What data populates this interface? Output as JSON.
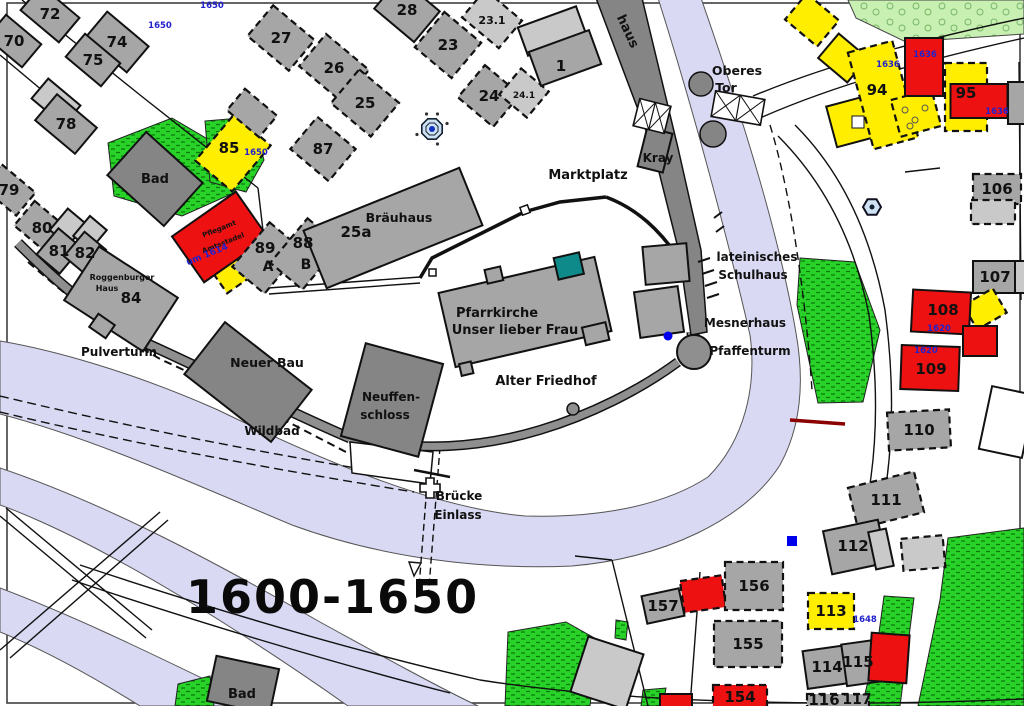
{
  "map": {
    "period_label": "1600-1650",
    "colors": {
      "gray": "#a6a6a6",
      "gray_dark": "#858585",
      "gray_light": "#c9c9c9",
      "yellow": "#ffee00",
      "red": "#ee1111",
      "white": "#ffffff",
      "teal": "#0e8a8a",
      "wall": "#8f8f8f",
      "water": "#d9d9f3",
      "green": "#28d228",
      "green_dark": "#0b7a0b",
      "green_light": "#c7f0b2",
      "year_blue": "#2222cc",
      "ink": "#111111",
      "dark_red": "#8b0000",
      "fountain_fill": "#cfe2f4",
      "dot_blue": "#1133bb"
    },
    "buildings": [
      {
        "id": "b70",
        "label": "70",
        "x": 14,
        "y": 41,
        "w": 46,
        "h": 30,
        "rot": 40,
        "f": "gray"
      },
      {
        "id": "b72",
        "label": "72",
        "x": 50,
        "y": 14,
        "w": 50,
        "h": 32,
        "rot": 40,
        "f": "gray"
      },
      {
        "id": "b74",
        "label": "74",
        "x": 117,
        "y": 42,
        "w": 54,
        "h": 34,
        "rot": 40,
        "f": "gray"
      },
      {
        "id": "b75",
        "label": "75",
        "x": 93,
        "y": 60,
        "w": 46,
        "h": 30,
        "rot": 40,
        "f": "gray"
      },
      {
        "id": "b78u",
        "x": 56,
        "y": 102,
        "w": 42,
        "h": 26,
        "rot": 40,
        "f": "gray_light"
      },
      {
        "id": "b78",
        "label": "78",
        "x": 66,
        "y": 124,
        "w": 52,
        "h": 34,
        "rot": 40,
        "f": "gray"
      },
      {
        "id": "b79",
        "label": "79",
        "x": 9,
        "y": 190,
        "w": 44,
        "h": 30,
        "rot": 40,
        "f": "gray",
        "dash": true
      },
      {
        "id": "b80",
        "label": "80",
        "x": 42,
        "y": 228,
        "w": 46,
        "h": 32,
        "rot": 40,
        "f": "gray",
        "dash": true
      },
      {
        "id": "b81u",
        "x": 68,
        "y": 227,
        "w": 24,
        "h": 28,
        "rot": 40,
        "f": "gray_light"
      },
      {
        "id": "b82u",
        "x": 90,
        "y": 233,
        "w": 22,
        "h": 26,
        "rot": 40,
        "f": "gray_light"
      },
      {
        "id": "b81",
        "label": "81",
        "x": 59,
        "y": 251,
        "w": 30,
        "h": 34,
        "rot": 40,
        "f": "gray"
      },
      {
        "id": "b82",
        "label": "82",
        "x": 85,
        "y": 253,
        "w": 28,
        "h": 32,
        "rot": 40,
        "f": "gray"
      },
      {
        "id": "b84",
        "label": "84",
        "lx": 131,
        "ly": 298,
        "x": 121,
        "y": 299,
        "w": 94,
        "h": 64,
        "rot": 33,
        "f": "gray"
      },
      {
        "id": "bad-top",
        "x": 155,
        "y": 179,
        "w": 76,
        "h": 58,
        "rot": 42,
        "f": "gray_dark"
      },
      {
        "id": "b85",
        "label": "85",
        "lx": 229,
        "ly": 148,
        "x": 233,
        "y": 153,
        "w": 48,
        "h": 60,
        "rot": 40,
        "f": "yellow",
        "dash": true
      },
      {
        "id": "bu1",
        "x": 252,
        "y": 113,
        "w": 42,
        "h": 28,
        "rot": 40,
        "f": "gray",
        "dash": true
      },
      {
        "id": "b87",
        "label": "87",
        "x": 323,
        "y": 149,
        "w": 50,
        "h": 42,
        "rot": 40,
        "f": "gray",
        "dash": true
      },
      {
        "id": "b27",
        "label": "27",
        "x": 281,
        "y": 38,
        "w": 54,
        "h": 40,
        "rot": 40,
        "f": "gray",
        "dash": true
      },
      {
        "id": "b26",
        "label": "26",
        "x": 334,
        "y": 68,
        "w": 56,
        "h": 42,
        "rot": 40,
        "f": "gray",
        "dash": true
      },
      {
        "id": "b25",
        "label": "25",
        "x": 365,
        "y": 103,
        "w": 52,
        "h": 44,
        "rot": 40,
        "f": "gray",
        "dash": true
      },
      {
        "id": "b28",
        "label": "28",
        "x": 407,
        "y": 10,
        "w": 52,
        "h": 40,
        "rot": 40,
        "f": "gray"
      },
      {
        "id": "b23",
        "label": "23",
        "x": 448,
        "y": 45,
        "w": 48,
        "h": 46,
        "rot": 40,
        "f": "gray",
        "dash": true
      },
      {
        "id": "b231",
        "label": "23.1",
        "x": 492,
        "y": 19,
        "w": 48,
        "h": 36,
        "rot": 40,
        "f": "gray_light",
        "dash": true,
        "ls": 11
      },
      {
        "id": "b24",
        "label": "24",
        "x": 489,
        "y": 96,
        "w": 46,
        "h": 42,
        "rot": 40,
        "f": "gray",
        "dash": true
      },
      {
        "id": "b241",
        "label": "24.1",
        "x": 524,
        "y": 93,
        "w": 36,
        "h": 34,
        "rot": 40,
        "f": "gray_light",
        "dash": true,
        "ls": 9
      },
      {
        "id": "b1u",
        "x": 552,
        "y": 31,
        "w": 62,
        "h": 30,
        "rot": -20,
        "f": "gray_light"
      },
      {
        "id": "b1",
        "label": "1",
        "lx": 561,
        "ly": 66,
        "x": 565,
        "y": 58,
        "w": 64,
        "h": 36,
        "rot": -20,
        "f": "gray"
      },
      {
        "id": "pflegstadel-y",
        "x": 237,
        "y": 262,
        "w": 52,
        "h": 40,
        "rot": -35,
        "f": "yellow",
        "dash": true
      },
      {
        "id": "pflegstadel",
        "x": 220,
        "y": 237,
        "w": 78,
        "h": 56,
        "rot": -35,
        "f": "red"
      },
      {
        "id": "b89",
        "label": "89",
        "lx": 265,
        "ly": 248,
        "x": 267,
        "y": 258,
        "w": 42,
        "h": 58,
        "rot": 40,
        "f": "gray",
        "dash": true
      },
      {
        "id": "b88",
        "label": "88",
        "lx": 303,
        "ly": 243,
        "x": 305,
        "y": 254,
        "w": 42,
        "h": 58,
        "rot": 40,
        "f": "gray",
        "dash": true
      },
      {
        "id": "b25a",
        "label": "25a",
        "lx": 356,
        "ly": 232,
        "x": 393,
        "y": 228,
        "w": 168,
        "h": 62,
        "rot": -22,
        "f": "gray"
      },
      {
        "id": "neuer-bau",
        "x": 248,
        "y": 382,
        "w": 110,
        "h": 66,
        "rot": 38,
        "f": "gray_dark"
      },
      {
        "id": "neuffenschloss",
        "x": 392,
        "y": 400,
        "w": 80,
        "h": 96,
        "rot": 15,
        "f": "gray_dark"
      },
      {
        "id": "mesner1",
        "x": 666,
        "y": 264,
        "w": 44,
        "h": 38,
        "rot": -5,
        "f": "gray"
      },
      {
        "id": "mesner2",
        "x": 659,
        "y": 312,
        "w": 44,
        "h": 46,
        "rot": -8,
        "f": "gray"
      },
      {
        "id": "kray-tower",
        "x": 655,
        "y": 150,
        "w": 26,
        "h": 40,
        "rot": 14,
        "f": "gray_dark"
      },
      {
        "id": "pulverturm-t",
        "x": 102,
        "y": 326,
        "w": 20,
        "h": 16,
        "rot": 35,
        "f": "gray"
      },
      {
        "id": "y1",
        "x": 812,
        "y": 20,
        "w": 42,
        "h": 34,
        "rot": 40,
        "f": "yellow",
        "dash": true
      },
      {
        "id": "y2",
        "x": 843,
        "y": 58,
        "w": 38,
        "h": 32,
        "rot": 40,
        "f": "yellow"
      },
      {
        "id": "y3",
        "x": 850,
        "y": 122,
        "w": 38,
        "h": 42,
        "rot": -15,
        "f": "yellow"
      },
      {
        "id": "b94",
        "label": "94",
        "lx": 877,
        "ly": 90,
        "x": 883,
        "y": 95,
        "w": 46,
        "h": 100,
        "rot": -15,
        "f": "yellow",
        "dash": true
      },
      {
        "id": "y4",
        "x": 916,
        "y": 113,
        "w": 42,
        "h": 38,
        "rot": -15,
        "f": "yellow",
        "dash": true
      },
      {
        "id": "red-top",
        "x": 924,
        "y": 67,
        "w": 38,
        "h": 58,
        "rot": 0,
        "f": "red"
      },
      {
        "id": "b95y",
        "x": 966,
        "y": 97,
        "w": 42,
        "h": 68,
        "rot": 0,
        "f": "yellow",
        "dash": true
      },
      {
        "id": "b95r",
        "label": "95",
        "lx": 966,
        "ly": 93,
        "x": 979,
        "y": 101,
        "w": 57,
        "h": 34,
        "rot": 0,
        "f": "red"
      },
      {
        "id": "edge-g1",
        "x": 1017,
        "y": 103,
        "w": 18,
        "h": 42,
        "rot": 0,
        "f": "gray"
      },
      {
        "id": "b106",
        "label": "106",
        "x": 997,
        "y": 189,
        "w": 48,
        "h": 30,
        "rot": 0,
        "f": "gray",
        "dash": true
      },
      {
        "id": "b106b",
        "x": 993,
        "y": 212,
        "w": 44,
        "h": 24,
        "rot": 0,
        "f": "gray_light",
        "dash": true
      },
      {
        "id": "b107",
        "label": "107",
        "lx": 995,
        "ly": 277,
        "x": 999,
        "y": 277,
        "w": 52,
        "h": 32,
        "rot": 0,
        "f": "gray"
      },
      {
        "id": "b107b",
        "x": 1021,
        "y": 277,
        "w": 12,
        "h": 32,
        "rot": 0,
        "f": "gray_light"
      },
      {
        "id": "y108",
        "x": 985,
        "y": 309,
        "w": 34,
        "h": 28,
        "rot": -30,
        "f": "yellow",
        "dash": true
      },
      {
        "id": "b108",
        "label": "108",
        "lx": 943,
        "ly": 310,
        "x": 941,
        "y": 312,
        "w": 58,
        "h": 42,
        "rot": 3,
        "f": "red"
      },
      {
        "id": "r108b",
        "x": 980,
        "y": 341,
        "w": 34,
        "h": 30,
        "rot": 0,
        "f": "red"
      },
      {
        "id": "b109",
        "label": "109",
        "lx": 931,
        "ly": 369,
        "x": 930,
        "y": 368,
        "w": 58,
        "h": 44,
        "rot": 2,
        "f": "red"
      },
      {
        "id": "b110",
        "label": "110",
        "x": 919,
        "y": 430,
        "w": 62,
        "h": 38,
        "rot": -3,
        "f": "gray",
        "dash": true
      },
      {
        "id": "white-right",
        "x": 1007,
        "y": 422,
        "w": 44,
        "h": 64,
        "rot": 12,
        "f": "white"
      },
      {
        "id": "b111",
        "label": "111",
        "x": 886,
        "y": 500,
        "w": 68,
        "h": 42,
        "rot": -14,
        "f": "gray",
        "dash": true
      },
      {
        "id": "b112",
        "label": "112",
        "lx": 853,
        "ly": 546,
        "x": 855,
        "y": 547,
        "w": 56,
        "h": 44,
        "rot": -12,
        "f": "gray"
      },
      {
        "id": "b112b",
        "x": 881,
        "y": 549,
        "w": 18,
        "h": 38,
        "rot": -12,
        "f": "gray_light"
      },
      {
        "id": "bu2",
        "x": 923,
        "y": 553,
        "w": 42,
        "h": 32,
        "rot": -5,
        "f": "gray_light",
        "dash": true
      },
      {
        "id": "gray-par",
        "x": 607,
        "y": 673,
        "w": 58,
        "h": 58,
        "rot": 18,
        "f": "gray_light"
      },
      {
        "id": "b157",
        "label": "157",
        "x": 663,
        "y": 606,
        "w": 38,
        "h": 28,
        "rot": -12,
        "f": "gray"
      },
      {
        "id": "r157",
        "x": 703,
        "y": 594,
        "w": 42,
        "h": 32,
        "rot": -8,
        "f": "red",
        "dash": true
      },
      {
        "id": "b156",
        "label": "156",
        "x": 754,
        "y": 586,
        "w": 58,
        "h": 48,
        "rot": 0,
        "f": "gray",
        "dash": true
      },
      {
        "id": "b155",
        "label": "155",
        "x": 748,
        "y": 644,
        "w": 68,
        "h": 46,
        "rot": 0,
        "f": "gray",
        "dash": true
      },
      {
        "id": "b113",
        "label": "113",
        "x": 831,
        "y": 611,
        "w": 46,
        "h": 36,
        "rot": 0,
        "f": "yellow",
        "dash": true
      },
      {
        "id": "b114",
        "label": "114",
        "x": 827,
        "y": 667,
        "w": 44,
        "h": 38,
        "rot": -8,
        "f": "gray"
      },
      {
        "id": "b115",
        "label": "115",
        "lx": 858,
        "ly": 662,
        "x": 861,
        "y": 663,
        "w": 34,
        "h": 42,
        "rot": -8,
        "f": "gray"
      },
      {
        "id": "r115",
        "x": 889,
        "y": 658,
        "w": 38,
        "h": 48,
        "rot": 4,
        "f": "red"
      },
      {
        "id": "b154",
        "label": "154",
        "x": 740,
        "y": 697,
        "w": 54,
        "h": 24,
        "rot": 0,
        "f": "red",
        "dash": true
      },
      {
        "id": "r154b",
        "x": 676,
        "y": 701,
        "w": 32,
        "h": 14,
        "rot": 0,
        "f": "red"
      },
      {
        "id": "b116",
        "label": "116",
        "lx": 824,
        "ly": 700,
        "x": 838,
        "y": 702,
        "w": 62,
        "h": 16,
        "rot": 0,
        "f": "gray",
        "dash": true
      },
      {
        "id": "bad-bottom",
        "x": 243,
        "y": 685,
        "w": 64,
        "h": 46,
        "rot": 12,
        "f": "gray_dark"
      }
    ],
    "places": [
      {
        "t": "Marktplatz",
        "x": 588,
        "y": 179,
        "s": 13
      },
      {
        "t": "Oberes",
        "x": 737,
        "y": 75,
        "s": 12.5
      },
      {
        "t": "Tor",
        "x": 726,
        "y": 92,
        "s": 12.5
      },
      {
        "t": "Kray",
        "x": 658,
        "y": 162,
        "s": 12
      },
      {
        "t": "haus",
        "x": 624,
        "y": 33,
        "s": 13,
        "r": 65
      },
      {
        "t": "Bräuhaus",
        "x": 399,
        "y": 222,
        "s": 12.5
      },
      {
        "t": "Pfarrkirche",
        "x": 497,
        "y": 317,
        "s": 13
      },
      {
        "t": "Unser lieber Frau",
        "x": 515,
        "y": 334,
        "s": 13
      },
      {
        "t": "Alter Friedhof",
        "x": 546,
        "y": 385,
        "s": 13
      },
      {
        "t": "Mesnerhaus",
        "x": 745,
        "y": 327,
        "s": 12
      },
      {
        "t": "Pfaffenturm",
        "x": 750,
        "y": 355,
        "s": 12
      },
      {
        "t": "lateinisches",
        "x": 757,
        "y": 261,
        "s": 12
      },
      {
        "t": "Schulhaus",
        "x": 753,
        "y": 279,
        "s": 12
      },
      {
        "t": "Roggenburger",
        "x": 122,
        "y": 280,
        "s": 8
      },
      {
        "t": "Haus",
        "x": 107,
        "y": 291,
        "s": 8
      },
      {
        "t": "Pulverturm",
        "x": 119,
        "y": 356,
        "s": 12
      },
      {
        "t": "Neuer Bau",
        "x": 267,
        "y": 367,
        "s": 12.5
      },
      {
        "t": "Wildbad",
        "x": 272,
        "y": 435,
        "s": 12
      },
      {
        "t": "Neuffen-",
        "x": 391,
        "y": 401,
        "s": 12
      },
      {
        "t": "schloss",
        "x": 385,
        "y": 419,
        "s": 12
      },
      {
        "t": "Brücke",
        "x": 459,
        "y": 500,
        "s": 12
      },
      {
        "t": "Einlass",
        "x": 458,
        "y": 519,
        "s": 12
      },
      {
        "t": "Bad",
        "x": 155,
        "y": 183,
        "s": 13
      },
      {
        "t": "Bad",
        "x": 242,
        "y": 698,
        "s": 13
      },
      {
        "t": "A",
        "x": 268,
        "y": 271,
        "s": 14,
        "w": 700
      },
      {
        "t": "B",
        "x": 306,
        "y": 269,
        "s": 14,
        "w": 700
      },
      {
        "t": "117",
        "x": 857,
        "y": 704,
        "s": 14,
        "w": 700
      },
      {
        "t": "Pflegamt",
        "x": 220,
        "y": 231,
        "s": 7,
        "r": -22,
        "w": 700
      },
      {
        "t": "Amtsstadel",
        "x": 224,
        "y": 245,
        "s": 7,
        "r": -22,
        "w": 700
      }
    ],
    "year_labels": [
      {
        "t": "1650",
        "x": 160,
        "y": 28
      },
      {
        "t": "1650",
        "x": 212,
        "y": 8
      },
      {
        "t": "1650",
        "x": 256,
        "y": 155
      },
      {
        "t": "1636",
        "x": 888,
        "y": 67
      },
      {
        "t": "1636",
        "x": 925,
        "y": 57
      },
      {
        "t": "1636",
        "x": 997,
        "y": 114
      },
      {
        "t": "um 1614",
        "x": 208,
        "y": 257,
        "r": -22,
        "s": 9
      },
      {
        "t": "1620",
        "x": 939,
        "y": 331
      },
      {
        "t": "1620",
        "x": 926,
        "y": 353
      },
      {
        "t": "1648",
        "x": 865,
        "y": 622
      }
    ],
    "icons": {
      "market_fountain": {
        "x": 432,
        "y": 129
      },
      "hex_marker": {
        "x": 872,
        "y": 207
      },
      "blue_dot": {
        "x": 668,
        "y": 336
      },
      "blue_square": {
        "x": 792,
        "y": 541
      }
    }
  }
}
